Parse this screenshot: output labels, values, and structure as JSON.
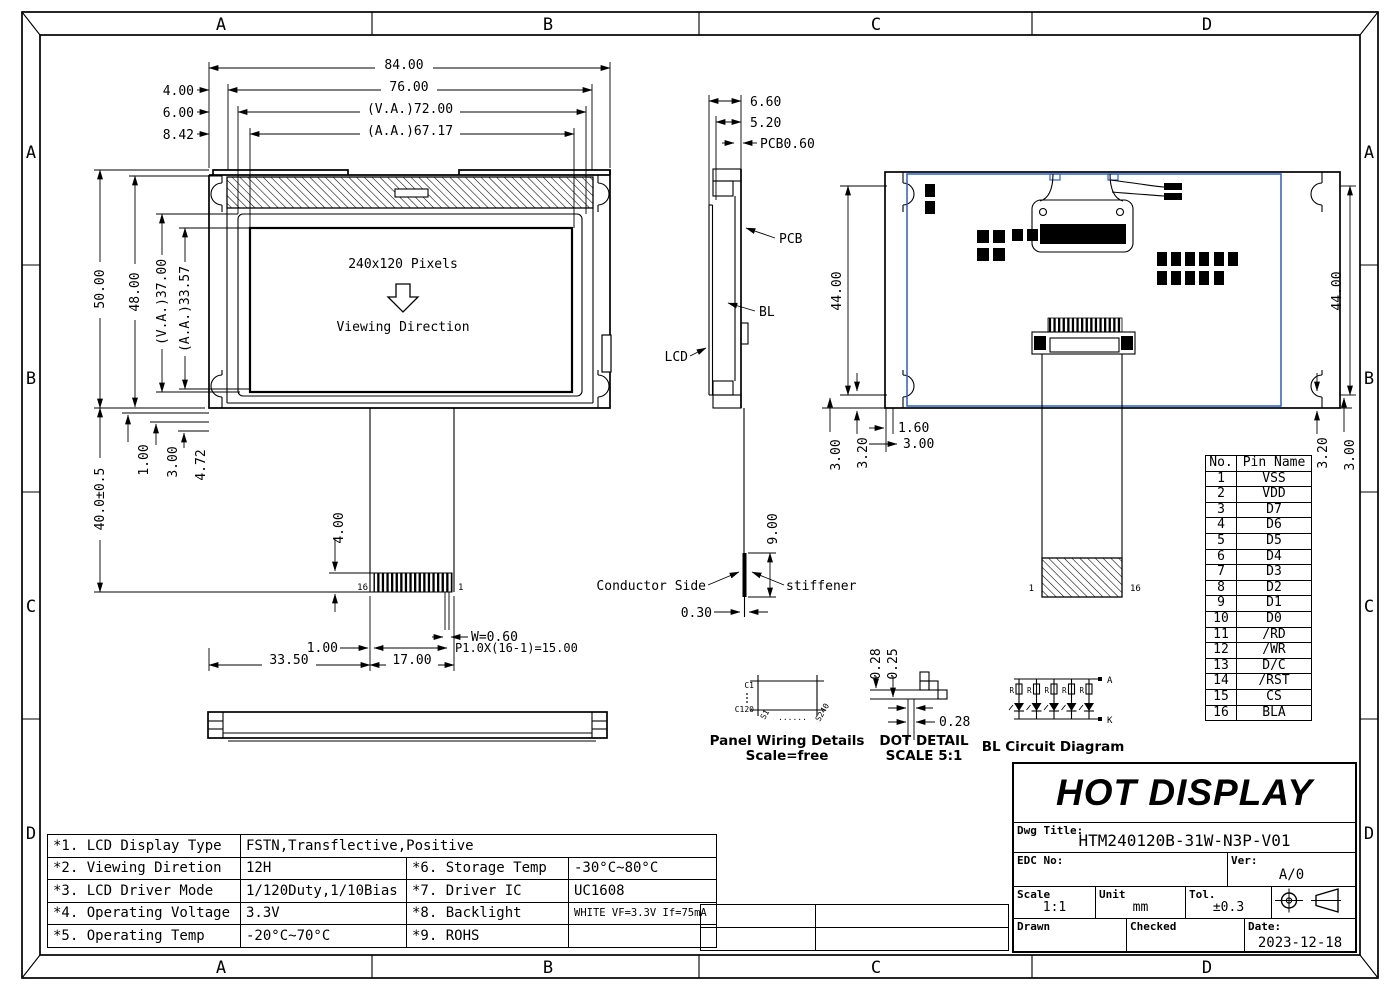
{
  "colors": {
    "line": "#000000",
    "pcb_blue": "#2a5fc7",
    "background": "#ffffff"
  },
  "frame": {
    "cols": [
      "A",
      "B",
      "C",
      "D"
    ],
    "rows": [
      "A",
      "B",
      "C",
      "D"
    ]
  },
  "front_view": {
    "screen_text": "240x120 Pixels",
    "viewing_text": "Viewing Direction",
    "pin_left": "16",
    "pin_right": "1",
    "dims": {
      "total_w": "84.00",
      "off4": "4.00",
      "w76": "76.00",
      "off6": "6.00",
      "va_w": "(V.A.)72.00",
      "off842": "8.42",
      "aa_w": "(A.A.)67.17",
      "total_h": "50.00",
      "h48": "48.00",
      "va_h": "(V.A.)37.00",
      "aa_h": "(A.A.)33.57",
      "b100": "1.00",
      "b300": "3.00",
      "b472": "4.72",
      "tail_len": "40.0±0.5",
      "conn_h": "4.00",
      "pin_w": "W=0.60",
      "pitch": "P1.0X(16-1)=15.00",
      "margin": "1.00",
      "d3350": "33.50",
      "d1700": "17.00"
    }
  },
  "side_view": {
    "labels": {
      "pcb": "PCB",
      "bl": "BL",
      "lcd": "LCD",
      "conductor": "Conductor Side",
      "stiffener": "stiffener"
    },
    "dims": {
      "d660": "6.60",
      "d520": "5.20",
      "pcb_t": "PCB0.60",
      "d900": "9.00",
      "d030": "0.30"
    }
  },
  "rear_view": {
    "pin_left": "1",
    "pin_right": "16",
    "dims": {
      "h44_left": "44.00",
      "h44_right": "44.00",
      "bl_300": "3.00",
      "bl_320": "3.20",
      "d160": "1.60",
      "d300": "3.00",
      "br_320": "3.20",
      "br_300": "3.00"
    }
  },
  "details": {
    "panel_wiring": {
      "title": "Panel Wiring Details",
      "subtitle": "Scale=free",
      "c_top": "C1",
      "c_bottom": "C120",
      "s_left": "S1",
      "s_right": "S240",
      "dots": "......"
    },
    "dot_detail": {
      "title": "DOT DETAIL",
      "subtitle": "SCALE 5:1",
      "gap_v1": "0.28",
      "gap_v2": "0.25",
      "gap_h1": "0.25",
      "gap_h2": "0.28"
    },
    "bl_circuit": {
      "title": "BL Circuit Diagram",
      "anode": "A",
      "cathode": "K",
      "resistor": "R"
    }
  },
  "pin_table": {
    "headers": [
      "No.",
      "Pin Name"
    ],
    "rows": [
      [
        "1",
        "VSS"
      ],
      [
        "2",
        "VDD"
      ],
      [
        "3",
        "D7"
      ],
      [
        "4",
        "D6"
      ],
      [
        "5",
        "D5"
      ],
      [
        "6",
        "D4"
      ],
      [
        "7",
        "D3"
      ],
      [
        "8",
        "D2"
      ],
      [
        "9",
        "D1"
      ],
      [
        "10",
        "D0"
      ],
      [
        "11",
        "/RD"
      ],
      [
        "12",
        "/WR"
      ],
      [
        "13",
        "D/C"
      ],
      [
        "14",
        "/RST"
      ],
      [
        "15",
        "CS"
      ],
      [
        "16",
        "BLA"
      ]
    ]
  },
  "spec_table": {
    "rows": [
      {
        "label": "*1. LCD Display Type",
        "value": "FSTN,Transflective,Positive",
        "label2": "",
        "value2": ""
      },
      {
        "label": "*2. Viewing Diretion",
        "value": "12H",
        "label2": "*6. Storage Temp",
        "value2": "-30°C~80°C"
      },
      {
        "label": "*3. LCD Driver Mode",
        "value": "1/120Duty,1/10Bias",
        "label2": "*7. Driver IC",
        "value2": "UC1608"
      },
      {
        "label": "*4. Operating Voltage",
        "value": "3.3V",
        "label2": "*8. Backlight",
        "value2": "WHITE VF=3.3V If=75mA"
      },
      {
        "label": "*5. Operating Temp",
        "value": "-20°C~70°C",
        "label2": "*9. ROHS",
        "value2": ""
      }
    ]
  },
  "title_block": {
    "company": "HOT DISPLAY",
    "dwg_title_label": "Dwg Title:",
    "dwg_title": "HTM240120B-31W-N3P-V01",
    "edc_label": "EDC No:",
    "ver_label": "Ver:",
    "ver": "A/0",
    "scale_label": "Scale",
    "scale": "1:1",
    "unit_label": "Unit",
    "unit": "mm",
    "tol_label": "Tol.",
    "tol": "±0.3",
    "drawn_label": "Drawn",
    "checked_label": "Checked",
    "date_label": "Date:",
    "date": "2023-12-18"
  }
}
